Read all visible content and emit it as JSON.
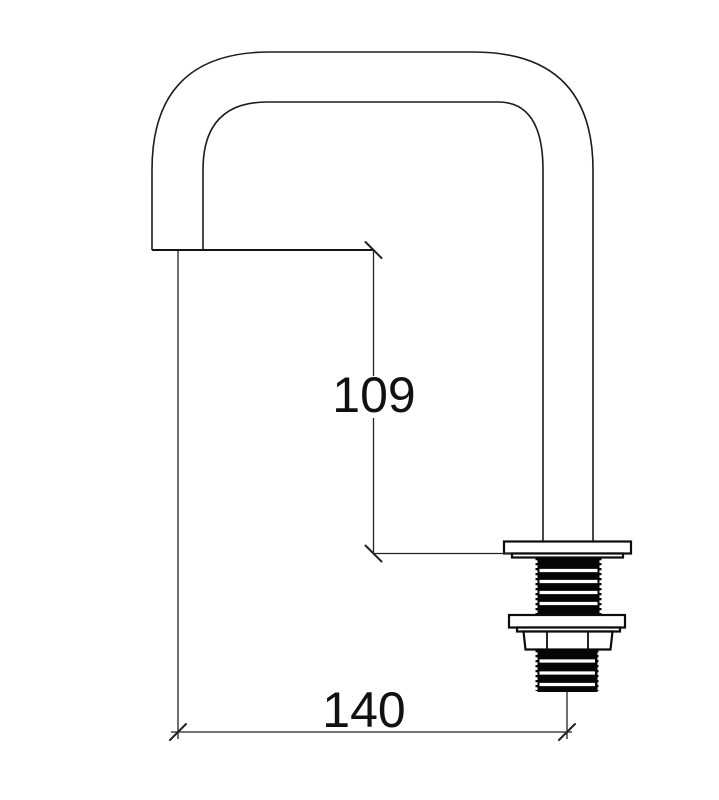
{
  "drawing": {
    "background_color": "#ffffff",
    "line_color": "#1c1c1c",
    "thread_fill_color": "#060606",
    "text_color": "#111111",
    "dimensions": {
      "spout_height": "109",
      "spout_reach": "140"
    }
  }
}
